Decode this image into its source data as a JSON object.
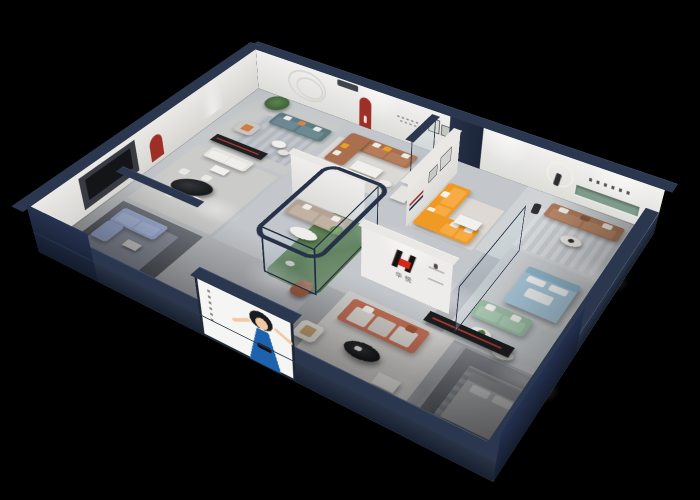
{
  "meta": {
    "description": "3D isometric cutaway rendering of a furniture showroom apartment floating on a black background, front walls sliced open revealing furnished rooms",
    "width_px": 700,
    "height_px": 500,
    "background_color": "#000000"
  },
  "brand": {
    "logo_text": "华悦",
    "logo_mark": "stylized H monogram in black and red on white feature wall",
    "logo_red": "#d3271c",
    "logo_black": "#17120e"
  },
  "billboard": {
    "content": "illustrated woman in a blue dress with outstretched arms on white poster panel",
    "dress_color": "#1d62ae",
    "panel_color": "#f5f5f3"
  },
  "palette": {
    "cut_wall_navy": "#2b374e",
    "deep_navy_face": "#1f2940",
    "wall_white": "#edecea",
    "floor_grey": "#bdc0c4",
    "atrium_green": "#5a7d52",
    "niche_red": "#9c2f26",
    "accent_orange_sofa": "#f09a26",
    "accent_leather": "#a96f4e",
    "accent_terracotta": "#bf6e55",
    "accent_blue_sofa": "#9fafd6",
    "accent_teal_sofa": "#5e7b83",
    "accent_green_sofa": "#9cbda6",
    "accent_bed_blue": "#a7c6d8",
    "wall_shelf_green": "#7e9c8b"
  },
  "rooms": [
    {
      "area": "top-left lounge",
      "key_furniture": "teal fabric sofa, grey armchair, potted tree, dark media console",
      "accent": "#5e7b83"
    },
    {
      "area": "dining room",
      "key_furniture": "black oval marble table with four white chairs, red arched wall niche",
      "accent": "#1c1d1f"
    },
    {
      "area": "left media room",
      "key_furniture": "light blue sectional sofa, TV wall, long dark console",
      "accent": "#9fafd6"
    },
    {
      "area": "leather lounge",
      "key_furniture": "caramel leather corner sofa with yellow pillows, red arched niche",
      "accent": "#a96f4e"
    },
    {
      "area": "center lounge",
      "key_furniture": "taupe sofa with oval coffee table",
      "accent": "#b4a394"
    },
    {
      "area": "glass atrium",
      "key_furniture": "glass planter box with cacti, plush bear figure",
      "accent": "#5a7d52"
    },
    {
      "area": "orange lounge",
      "key_furniture": "orange L-shaped sofa, white coffee table, runner sculpture with ring light",
      "accent": "#f09a26"
    },
    {
      "area": "right lounge",
      "key_furniture": "brown fabric sofa, recessed green wall shelf with lettering",
      "accent": "#aa7a5c"
    },
    {
      "area": "bed showroom",
      "key_furniture": "light blue bed with tray, sage green sofa, round side table",
      "accent": "#a7c6d8"
    },
    {
      "area": "brand lounge",
      "key_furniture": "terracotta sofa, black oval coffee table, white ottoman, logo feature wall",
      "accent": "#bf6e55"
    },
    {
      "area": "front bedroom",
      "key_furniture": "white bed in dim cutaway room",
      "accent": "#b9babd"
    }
  ]
}
